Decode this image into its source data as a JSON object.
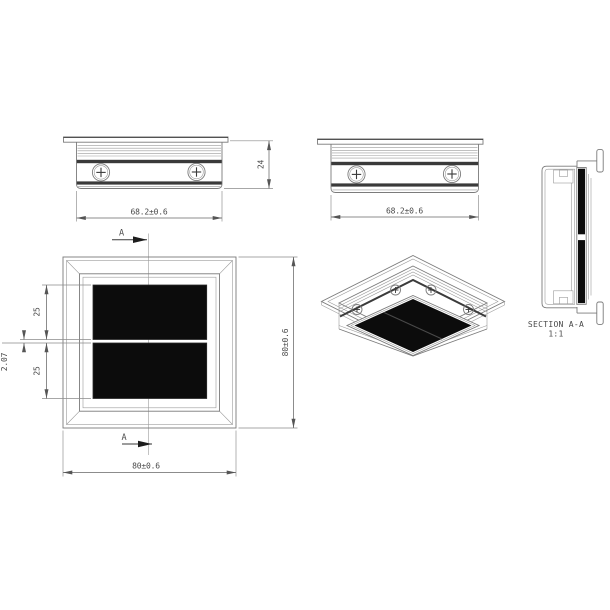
{
  "drawing": {
    "background": "#ffffff",
    "line_color": "#7b7b7b",
    "dark_band_color": "#3a3a3a",
    "dimension_color": "#666666",
    "panel_color": "#0c0c0c"
  },
  "views": {
    "side_left": {
      "dim_width": "68.2±0.6",
      "dim_height": "24"
    },
    "side_front": {
      "dim_width": "68.2±0.6"
    },
    "front": {
      "dim_width": "80±0.6",
      "dim_height": "80±0.6",
      "dim_segment_upper": "25",
      "dim_segment_lower": "25",
      "dim_gap": "2.07",
      "cut_label": "A"
    },
    "section": {
      "label": "SECTION A-A",
      "scale": "1:1"
    }
  }
}
